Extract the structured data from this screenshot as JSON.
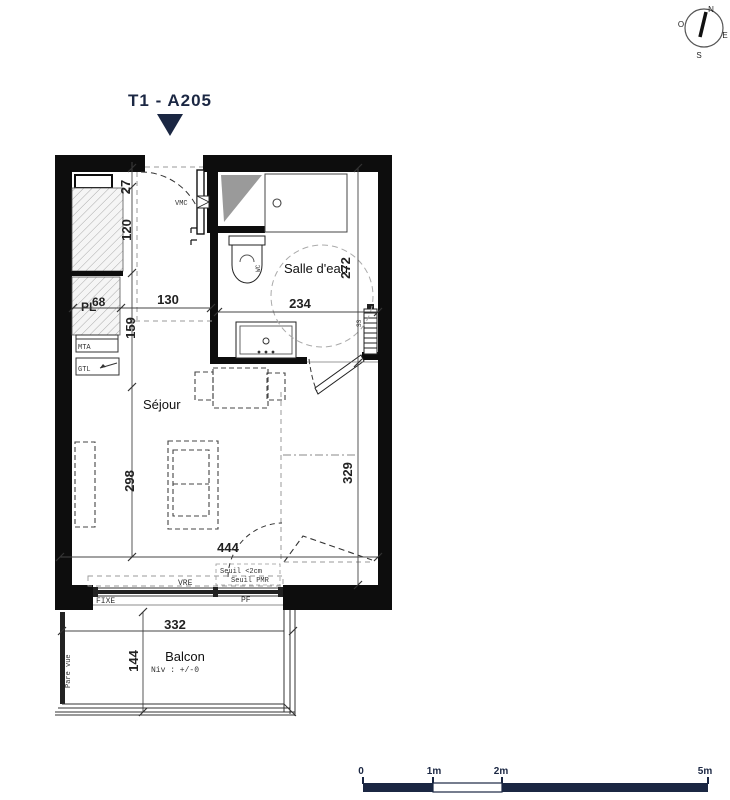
{
  "meta": {
    "title": "T1 - A205"
  },
  "compass": {
    "north": "N",
    "west": "O",
    "east": "E",
    "south": "S"
  },
  "rooms": {
    "bathroom": "Salle d'eau",
    "living": "Séjour",
    "balcony": "Balcon",
    "balcony_level": "Niv : +/-0"
  },
  "equipment": {
    "vmc": "VMC",
    "wc": "WC",
    "towel_radiator": "SS",
    "closet": "PL",
    "closet_width": "68",
    "mta": "MTA",
    "gtl": "GTL",
    "shutter": "VRE",
    "fixed_window": "FIXE",
    "french_window": "PF",
    "threshold_1": "Seuil <2cm",
    "threshold_2": "Seuil PMR",
    "privacy_screen": "Pare vue"
  },
  "dimensions_cm": {
    "entry": "27",
    "hall_depth": "120",
    "hall_width": "130",
    "closet_zone": "159",
    "bath_width": "234",
    "bath_depth": "272",
    "living_left": "298",
    "living_right": "329",
    "living_width": "444",
    "balcony_width": "332",
    "balcony_depth": "144"
  },
  "scale_bar": {
    "zero": "0",
    "one": "1m",
    "two": "2m",
    "five": "5m"
  },
  "colors": {
    "navy": "#1b2743",
    "ink": "#0d0d0d"
  }
}
